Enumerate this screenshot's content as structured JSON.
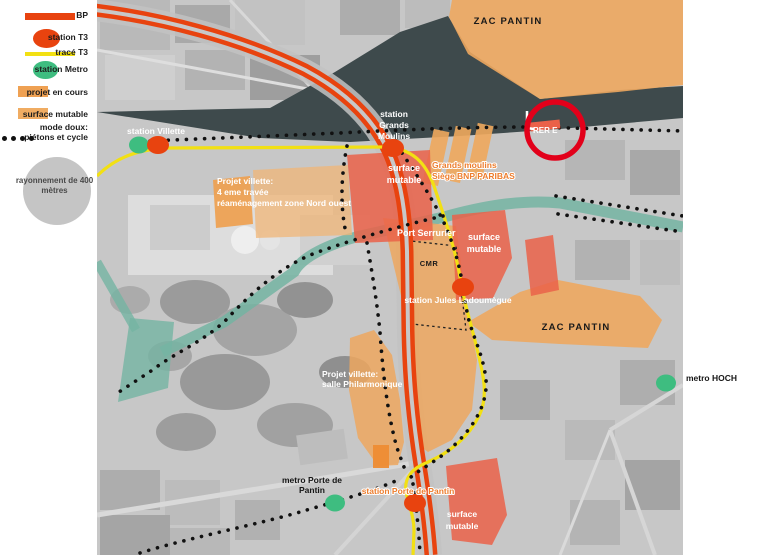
{
  "legend": {
    "items": [
      {
        "id": "bp",
        "label": "BP"
      },
      {
        "id": "station-t3",
        "label": "station T3"
      },
      {
        "id": "trace-t3",
        "label": "tracé T3"
      },
      {
        "id": "station-metro",
        "label": "station Metro"
      },
      {
        "id": "projet-en-cours",
        "label": "projet en cours"
      },
      {
        "id": "surface-mutable",
        "label": "surface mutable"
      },
      {
        "id": "mode-doux",
        "label_line1": "mode doux:",
        "label_line2": "piétons et cycle"
      }
    ],
    "radius_circle": {
      "line1": "rayonnement de 400",
      "line2": "mètres"
    }
  },
  "map": {
    "labels": {
      "zac_pantin_top": "ZAC PANTIN",
      "station_villette": "station Villette",
      "station_grands_moulins": [
        "station",
        "Grands",
        "Moulins"
      ],
      "surface_mutable_nw": [
        "surface",
        "mutable"
      ],
      "grands_moulins_bnp": [
        "Grands moulins",
        "Siège BNP PARIBAS"
      ],
      "projet_villette_nord": [
        "Projet villette:",
        "4 eme travée",
        "réaménagement zone Nord ouest"
      ],
      "port_serrurier": "Port Serrurier",
      "cmr": "CMR",
      "surface_mutable_center": [
        "surface",
        "mutable"
      ],
      "station_jules_ladoumegue": "station Jules Ladoumègue",
      "zac_pantin_east": "ZAC PANTIN",
      "metro_hoch": "metro HOCH",
      "projet_villette_salle": [
        "Projet villette:",
        "salle Philarmonique"
      ],
      "metro_porte_de_pantin": [
        "metro Porte de",
        "Pantin"
      ],
      "station_porte_de_pantin": "station Porte de Pantin",
      "surface_mutable_south": [
        "surface",
        "mutable"
      ],
      "rer_e": "RER E"
    },
    "colors": {
      "bp_line": "#E8430F",
      "trace_t3": "#F2E013",
      "station_metro": "#3EBD80",
      "projet_en_cours": "#EFA153",
      "surface_mutable_legend": "#F0AC62",
      "surface_mutable_map": "#EA6149",
      "mode_doux": "#111111",
      "rer_circle": "#E2001A",
      "rail_corridor": "#3E4A4C",
      "canal": "#74B4A2"
    }
  }
}
